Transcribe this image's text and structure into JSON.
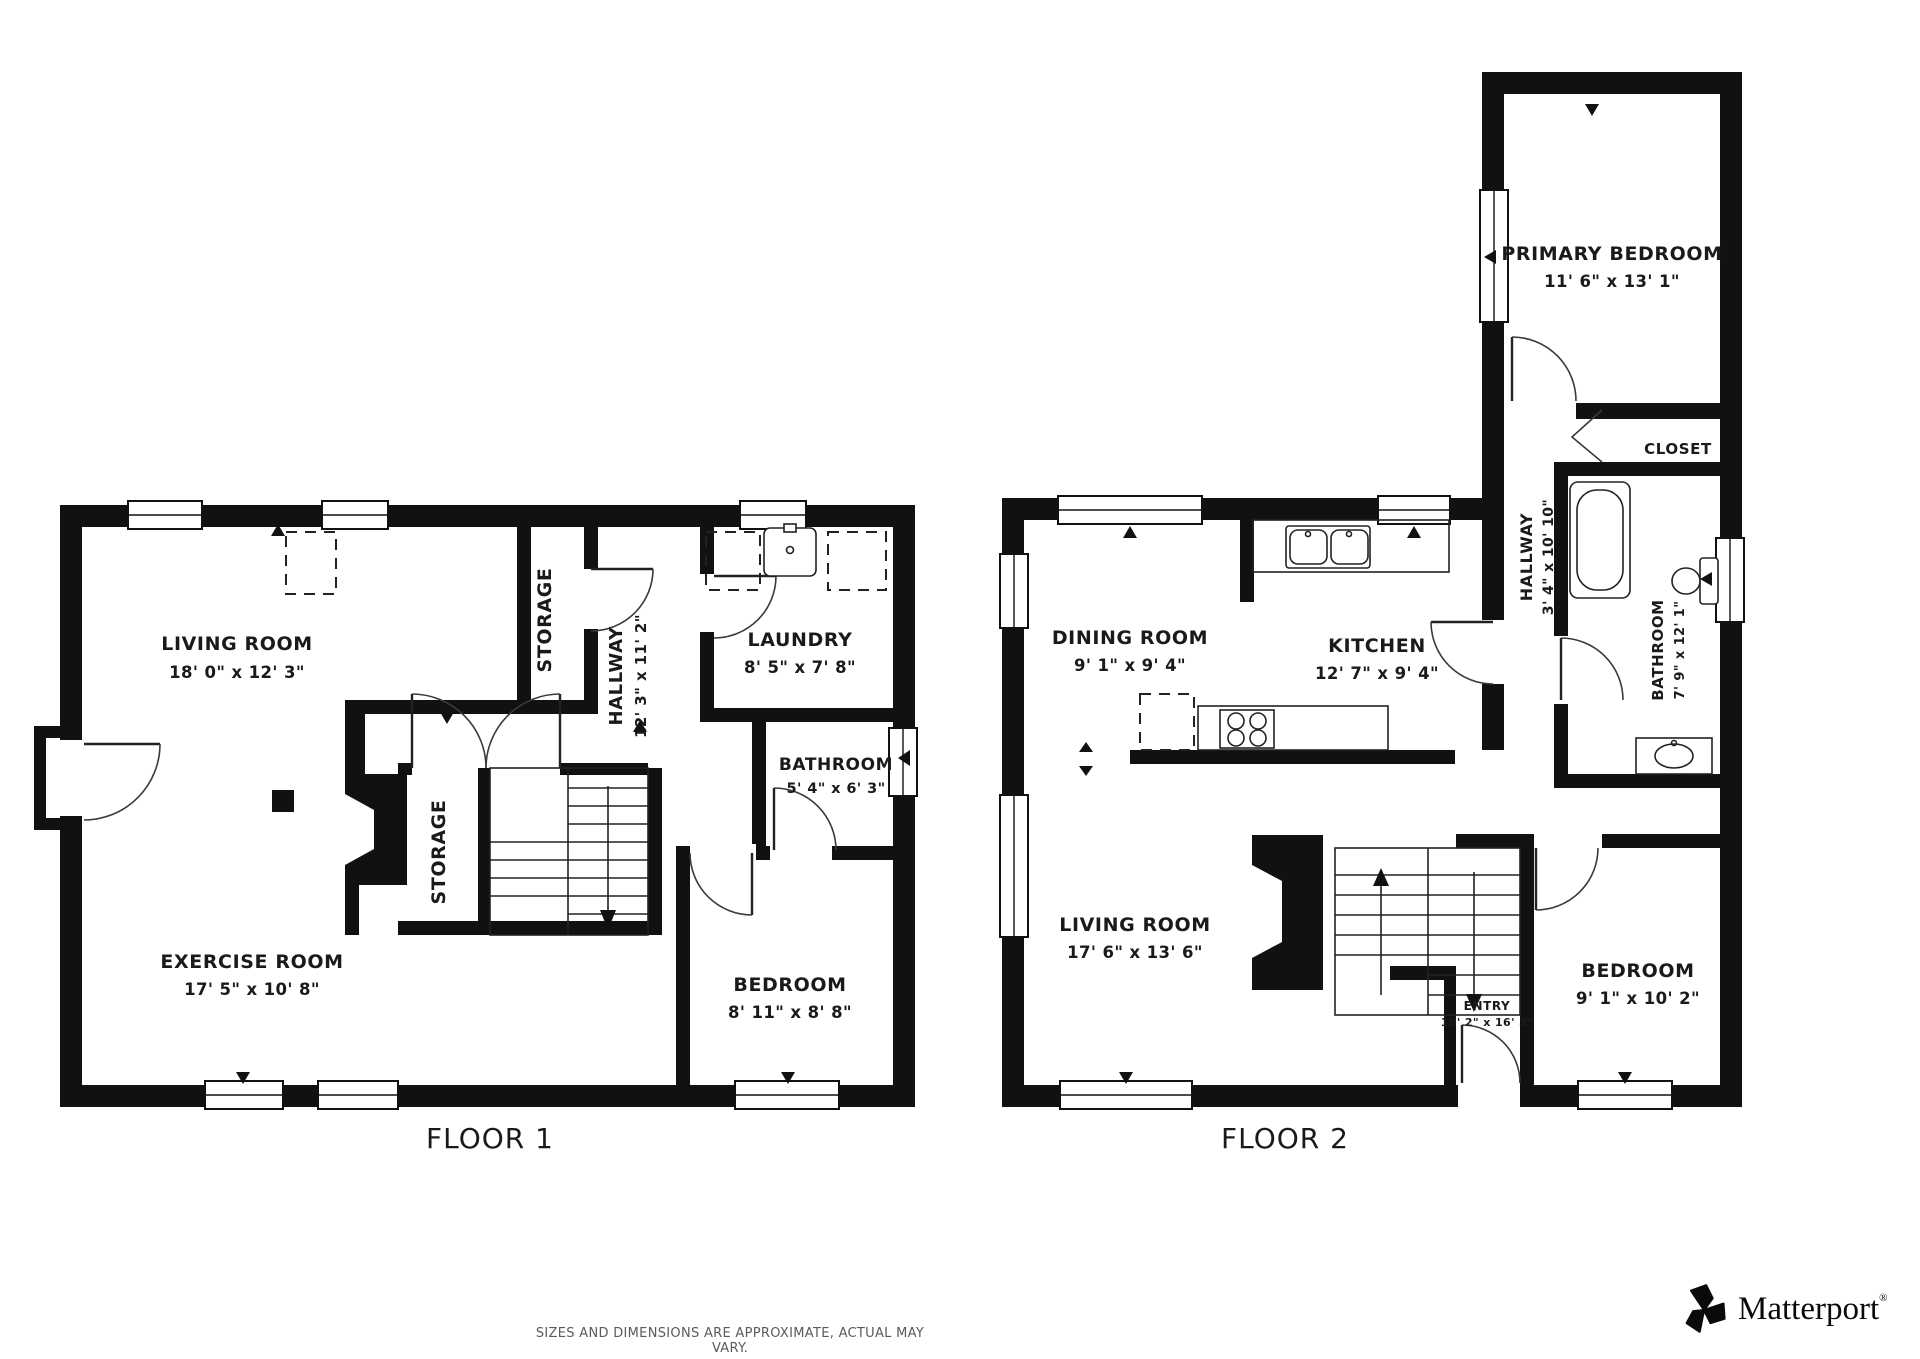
{
  "floors": [
    {
      "name": "FLOOR 1",
      "rooms": [
        {
          "label": "LIVING ROOM",
          "dims": "18' 0\" x 12' 3\""
        },
        {
          "label": "STORAGE",
          "dims": ""
        },
        {
          "label": "HALLWAY",
          "dims": "12' 3\" x 11' 2\""
        },
        {
          "label": "LAUNDRY",
          "dims": "8' 5\" x 7' 8\""
        },
        {
          "label": "BATHROOM",
          "dims": "5' 4\" x 6' 3\""
        },
        {
          "label": "STORAGE",
          "dims": ""
        },
        {
          "label": "EXERCISE ROOM",
          "dims": "17' 5\" x 10' 8\""
        },
        {
          "label": "BEDROOM",
          "dims": "8' 11\" x 8' 8\""
        }
      ]
    },
    {
      "name": "FLOOR 2",
      "rooms": [
        {
          "label": "PRIMARY BEDROOM",
          "dims": "11' 6\" x 13' 1\""
        },
        {
          "label": "CLOSET",
          "dims": ""
        },
        {
          "label": "HALLWAY",
          "dims": "3' 4\" x 10' 10\""
        },
        {
          "label": "BATHROOM",
          "dims": "7' 9\" x 12' 1\""
        },
        {
          "label": "DINING ROOM",
          "dims": "9' 1\" x 9' 4\""
        },
        {
          "label": "KITCHEN",
          "dims": "12' 7\" x 9' 4\""
        },
        {
          "label": "LIVING ROOM",
          "dims": "17' 6\" x 13' 6\""
        },
        {
          "label": "BEDROOM",
          "dims": "9' 1\" x 10' 2\""
        },
        {
          "label": "ENTRY",
          "dims": "10' 2\" x 16' 3\""
        }
      ]
    }
  ],
  "footer": {
    "disclaimer": "SIZES AND DIMENSIONS ARE APPROXIMATE, ACTUAL MAY VARY."
  },
  "branding": {
    "logo_text": "Matterport",
    "registered_mark": "®",
    "icon": "matterport-pinwheel-icon"
  },
  "colors": {
    "wall": "#111111",
    "background": "#ffffff",
    "text": "#1a1a1a",
    "disclaimer_text": "#5a5a5a"
  }
}
